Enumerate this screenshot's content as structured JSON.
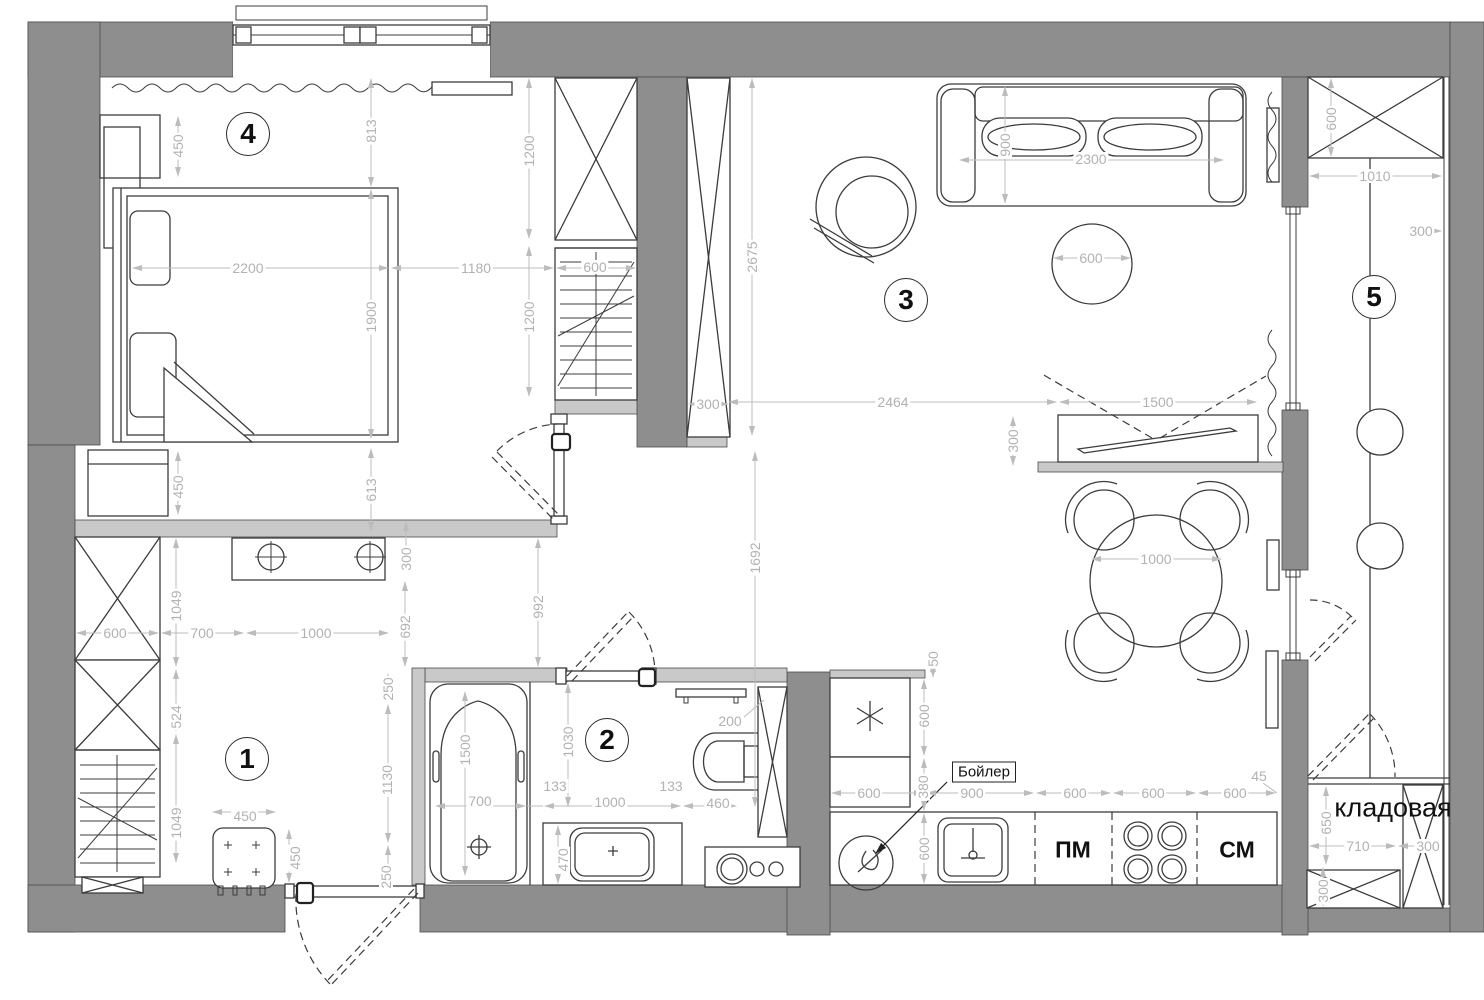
{
  "plan_title": "apartment floor plan",
  "colors": {
    "wall": "#8e8e8e",
    "partition": "#c9c9c9",
    "dimension": "#b2b2b2",
    "line": "#3c3c3c"
  },
  "rooms": [
    {
      "number": "1",
      "x": 247,
      "y": 759
    },
    {
      "number": "2",
      "x": 607,
      "y": 740
    },
    {
      "number": "3",
      "x": 906,
      "y": 300
    },
    {
      "number": "4",
      "x": 248,
      "y": 134
    },
    {
      "number": "5",
      "x": 1374,
      "y": 297
    }
  ],
  "texts": [
    {
      "t": "кладовая",
      "x": 1393,
      "y": 808,
      "size": 27
    },
    {
      "t": "ПМ",
      "x": 1073,
      "y": 850,
      "size": 23,
      "bold": 1
    },
    {
      "t": "СМ",
      "x": 1237,
      "y": 850,
      "size": 23,
      "bold": 1
    },
    {
      "t": "Бойлер",
      "x": 984,
      "y": 772,
      "size": 15,
      "boxed": 1
    }
  ],
  "dimensions": [
    {
      "t": "450",
      "x": 178,
      "y": 146,
      "v": 1
    },
    {
      "t": "813",
      "x": 371,
      "y": 131,
      "v": 1
    },
    {
      "t": "1200",
      "x": 529,
      "y": 151,
      "v": 1
    },
    {
      "t": "2200",
      "x": 248,
      "y": 268
    },
    {
      "t": "1180",
      "x": 476,
      "y": 268
    },
    {
      "t": "600",
      "x": 595,
      "y": 267
    },
    {
      "t": "1900",
      "x": 371,
      "y": 317,
      "v": 1
    },
    {
      "t": "1200",
      "x": 529,
      "y": 317,
      "v": 1
    },
    {
      "t": "450",
      "x": 178,
      "y": 487,
      "v": 1
    },
    {
      "t": "613",
      "x": 371,
      "y": 490,
      "v": 1
    },
    {
      "t": "2675",
      "x": 752,
      "y": 257,
      "v": 1
    },
    {
      "t": "300",
      "x": 708,
      "y": 404
    },
    {
      "t": "900",
      "x": 1005,
      "y": 145,
      "v": 1
    },
    {
      "t": "2300",
      "x": 1091,
      "y": 159
    },
    {
      "t": "600",
      "x": 1091,
      "y": 258
    },
    {
      "t": "2464",
      "x": 893,
      "y": 402
    },
    {
      "t": "1500",
      "x": 1158,
      "y": 402
    },
    {
      "t": "300",
      "x": 1013,
      "y": 441,
      "v": 1
    },
    {
      "t": "1692",
      "x": 755,
      "y": 558,
      "v": 1
    },
    {
      "t": "1000",
      "x": 1156,
      "y": 559
    },
    {
      "t": "600",
      "x": 1331,
      "y": 119,
      "v": 1
    },
    {
      "t": "1010",
      "x": 1375,
      "y": 176
    },
    {
      "t": "300",
      "x": 1421,
      "y": 231
    },
    {
      "t": "50",
      "x": 933,
      "y": 659,
      "v": 1
    },
    {
      "t": "600",
      "x": 924,
      "y": 716,
      "v": 1
    },
    {
      "t": "380",
      "x": 923,
      "y": 787,
      "v": 1
    },
    {
      "t": "600",
      "x": 869,
      "y": 793
    },
    {
      "t": "900",
      "x": 972,
      "y": 793
    },
    {
      "t": "600",
      "x": 1075,
      "y": 793
    },
    {
      "t": "600",
      "x": 1153,
      "y": 793
    },
    {
      "t": "600",
      "x": 1235,
      "y": 793
    },
    {
      "t": "45",
      "x": 1259,
      "y": 776
    },
    {
      "t": "600",
      "x": 924,
      "y": 849,
      "v": 1
    },
    {
      "t": "992",
      "x": 538,
      "y": 607,
      "v": 1
    },
    {
      "t": "692",
      "x": 405,
      "y": 627,
      "v": 1
    },
    {
      "t": "1030",
      "x": 568,
      "y": 742,
      "v": 1
    },
    {
      "t": "1500",
      "x": 465,
      "y": 750,
      "v": 1
    },
    {
      "t": "700",
      "x": 480,
      "y": 801
    },
    {
      "t": "133",
      "x": 555,
      "y": 786
    },
    {
      "t": "1000",
      "x": 610,
      "y": 802
    },
    {
      "t": "133",
      "x": 671,
      "y": 786
    },
    {
      "t": "460",
      "x": 718,
      "y": 803
    },
    {
      "t": "470",
      "x": 563,
      "y": 860,
      "v": 1
    },
    {
      "t": "200",
      "x": 730,
      "y": 721
    },
    {
      "t": "1049",
      "x": 176,
      "y": 606,
      "v": 1
    },
    {
      "t": "600",
      "x": 115,
      "y": 633
    },
    {
      "t": "700",
      "x": 202,
      "y": 633
    },
    {
      "t": "1000",
      "x": 316,
      "y": 633
    },
    {
      "t": "300",
      "x": 406,
      "y": 559,
      "v": 1
    },
    {
      "t": "524",
      "x": 176,
      "y": 717,
      "v": 1
    },
    {
      "t": "1049",
      "x": 176,
      "y": 823,
      "v": 1
    },
    {
      "t": "450",
      "x": 245,
      "y": 816
    },
    {
      "t": "450",
      "x": 295,
      "y": 858,
      "v": 1
    },
    {
      "t": "250",
      "x": 388,
      "y": 689,
      "v": 1
    },
    {
      "t": "1130",
      "x": 387,
      "y": 780,
      "v": 1
    },
    {
      "t": "250",
      "x": 386,
      "y": 877,
      "v": 1
    },
    {
      "t": "650",
      "x": 1326,
      "y": 823,
      "v": 1
    },
    {
      "t": "710",
      "x": 1358,
      "y": 846
    },
    {
      "t": "300",
      "x": 1428,
      "y": 846
    },
    {
      "t": "300",
      "x": 1323,
      "y": 891,
      "v": 1
    }
  ]
}
